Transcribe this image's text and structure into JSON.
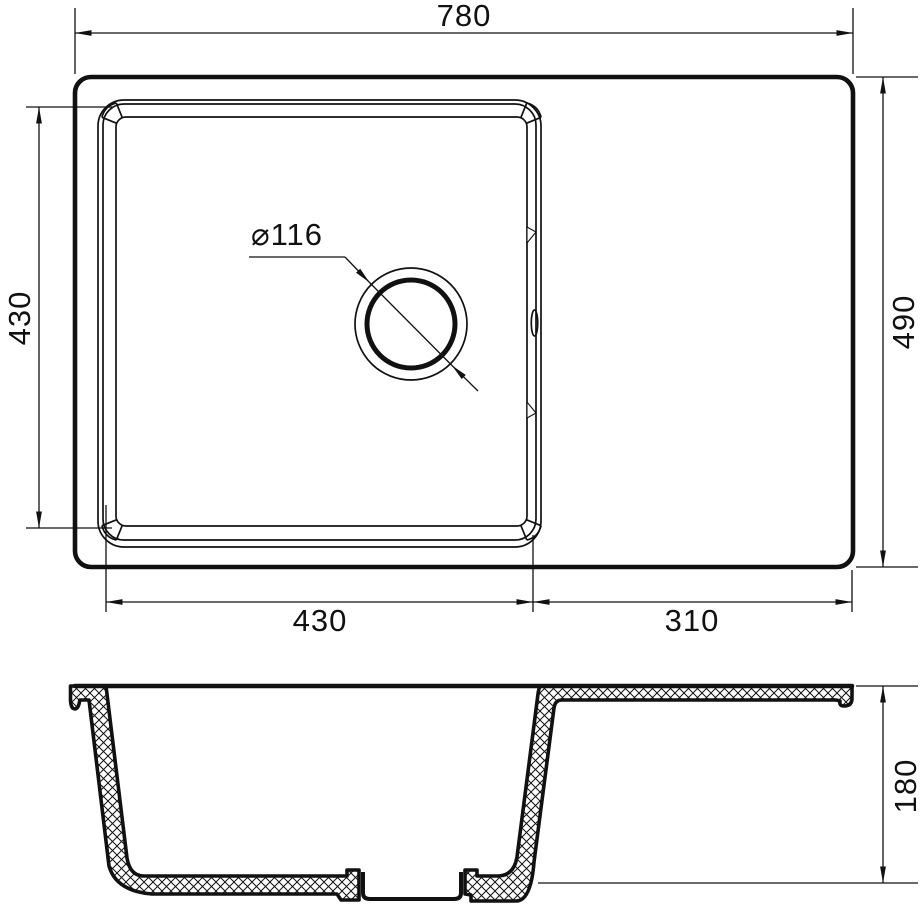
{
  "drawing": {
    "type": "kitchen-sink-dimension-drawing",
    "views": [
      "top-view",
      "cross-section-view"
    ]
  },
  "dims": {
    "total_width": "780",
    "total_depth": "490",
    "bowl_depth_left": "430",
    "bowl_width_bottom": "430",
    "drainer_width": "310",
    "drain_diameter": "⌀116",
    "bowl_height": "180"
  },
  "colors": {
    "ink": "#111111",
    "background": "#ffffff"
  }
}
